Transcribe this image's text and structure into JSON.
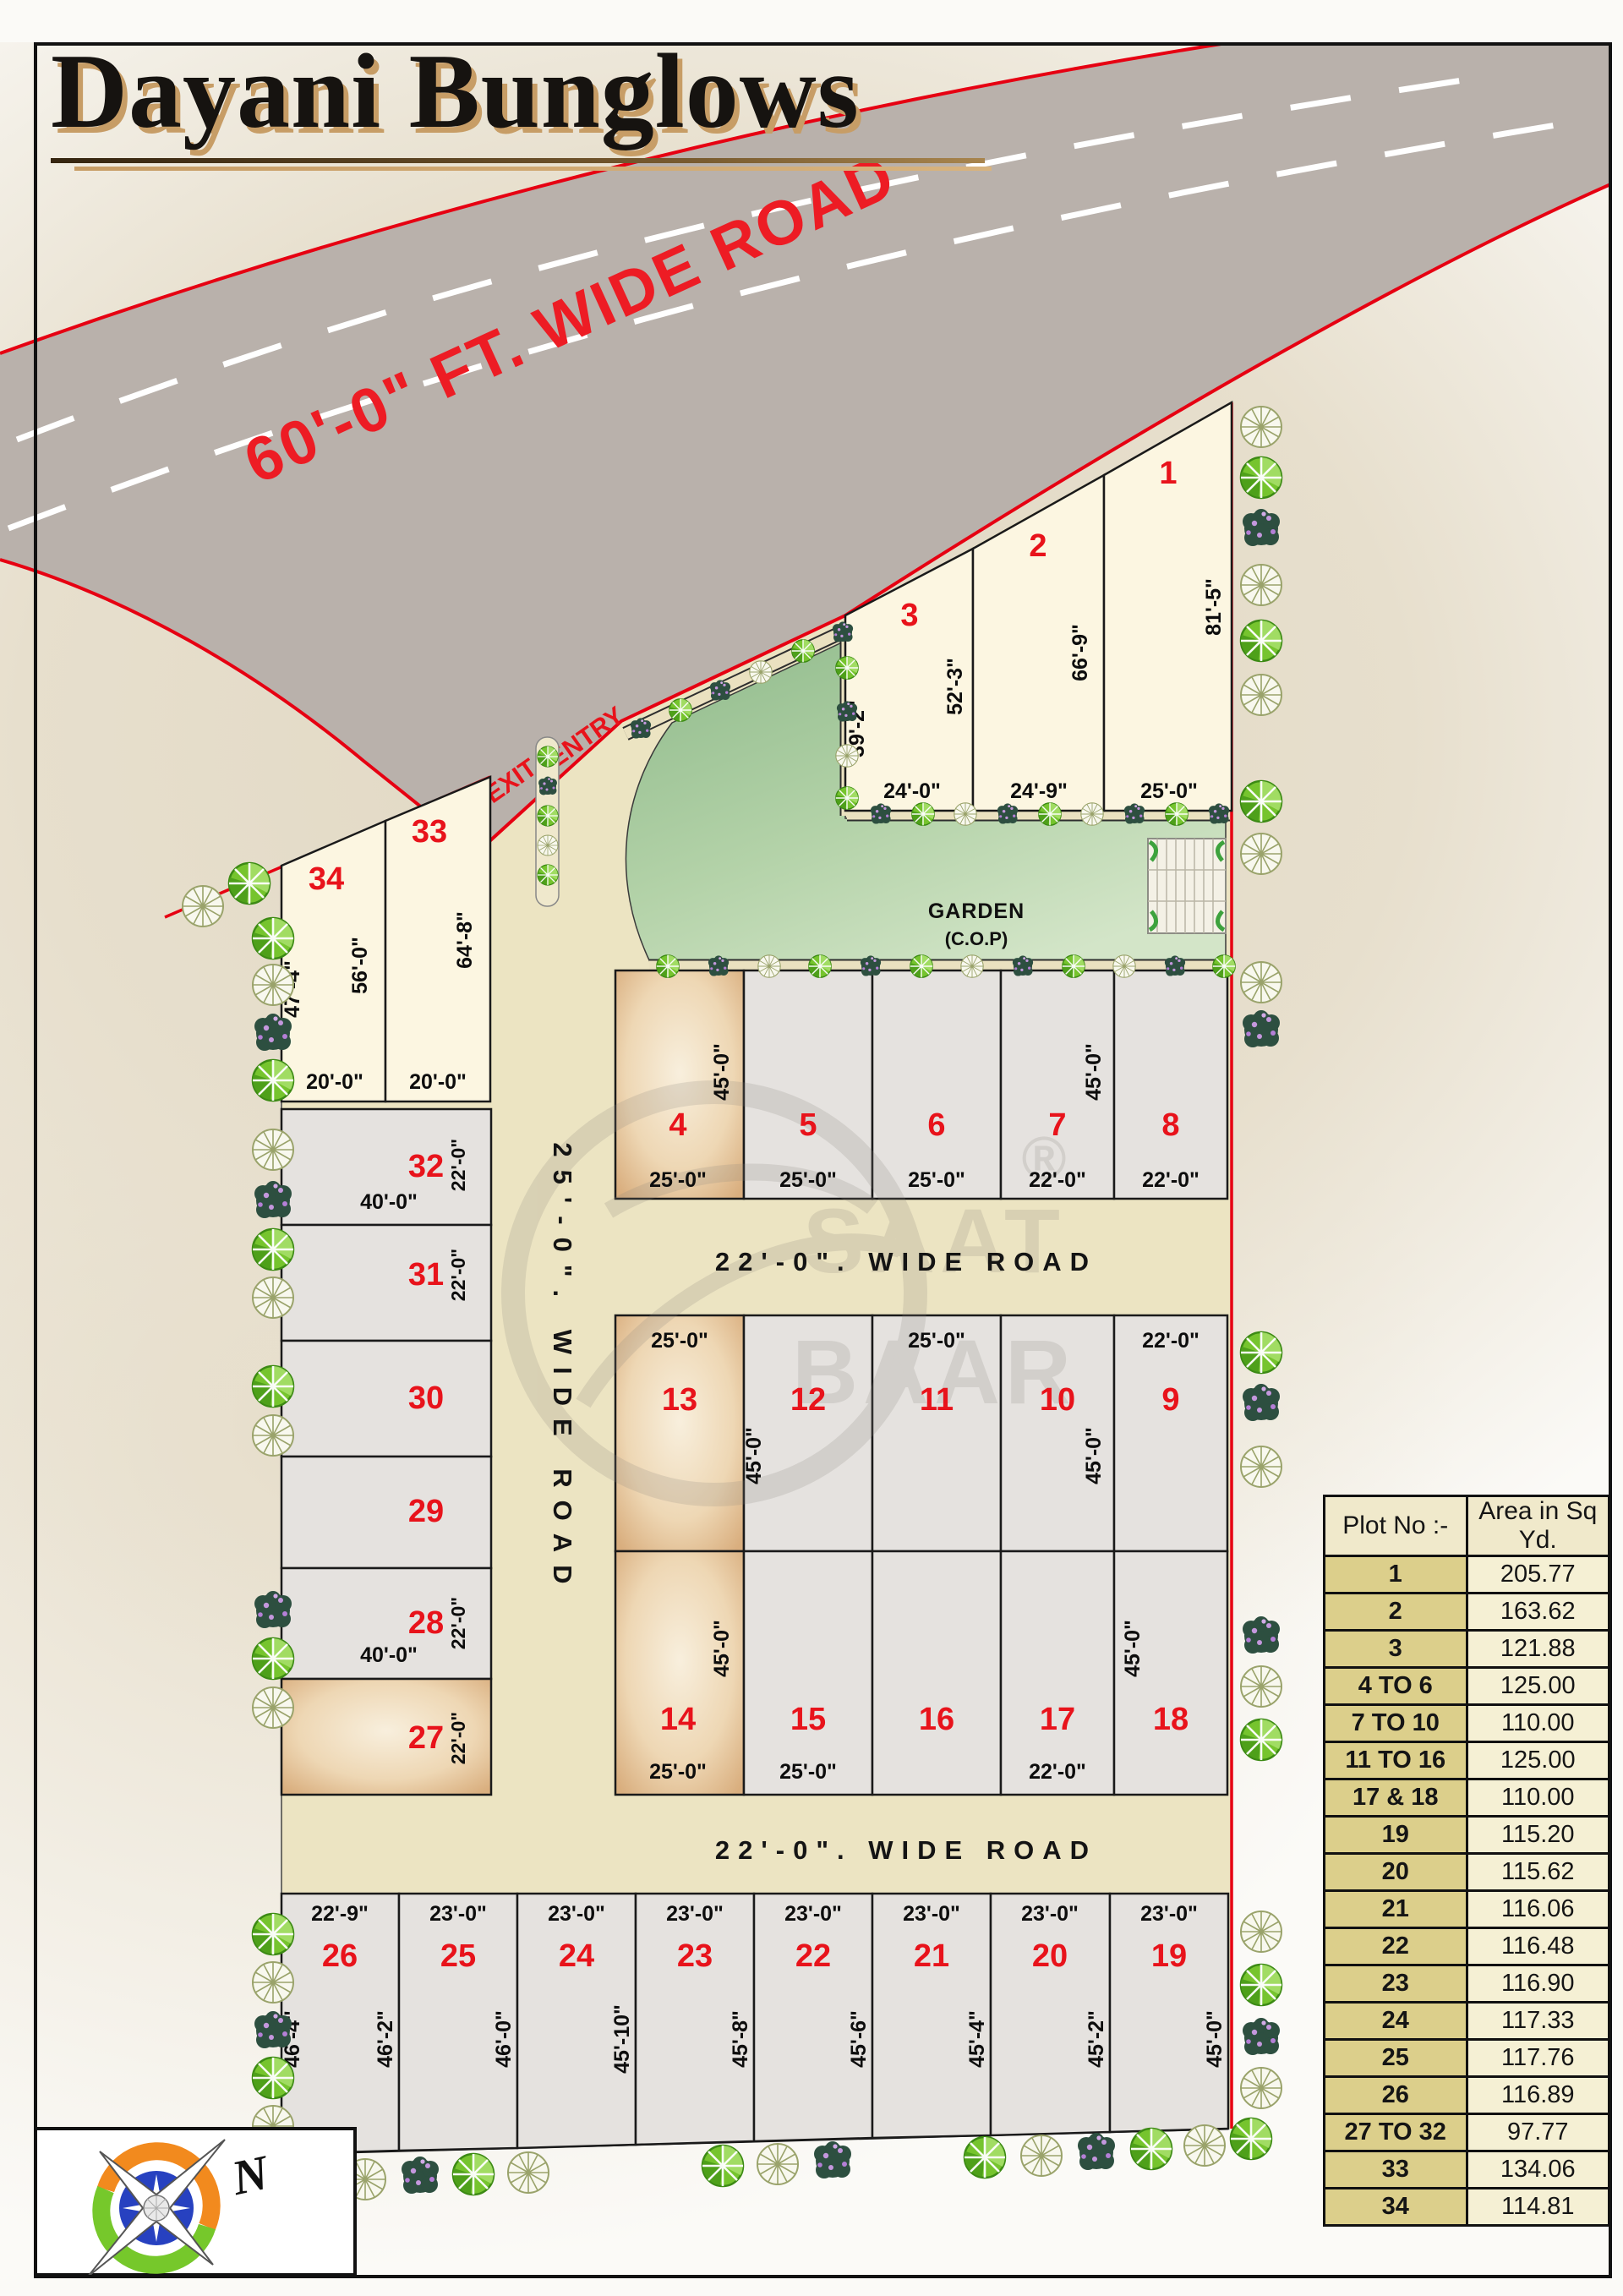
{
  "title": "Dayani Bunglows",
  "watermark": {
    "line1": "SAAT",
    "line2": "BAAR",
    "reg": "®"
  },
  "compass": {
    "north": "N"
  },
  "roads": {
    "main": "60'-0\"  FT. WIDE ROAD",
    "vertical": "25'-0\". WIDE ROAD",
    "cross1": "22'-0\". WIDE ROAD",
    "cross2": "22'-0\". WIDE ROAD",
    "entry": "ENTRY",
    "exit": "EXIT"
  },
  "garden": {
    "name": "GARDEN",
    "type": "(C.O.P)"
  },
  "colors": {
    "plot_number": "#e8131b",
    "road_line": "#e60012",
    "garden_green": "#9ec49a",
    "sold_tan": "#d9af80"
  },
  "plots": {
    "p1": {
      "no": "1",
      "side": "81'-5\"",
      "bottom": "25'-0\""
    },
    "p2": {
      "no": "2",
      "side": "66'-9\"",
      "bottom": "24'-9\""
    },
    "p3": {
      "no": "3",
      "left": "39'-2\"",
      "side": "52'-3\"",
      "bottom": "24'-0\""
    },
    "p4": {
      "no": "4",
      "side": "45'-0\"",
      "bottom": "25'-0\""
    },
    "p5": {
      "no": "5",
      "bottom": "25'-0\""
    },
    "p6": {
      "no": "6",
      "bottom": "25'-0\""
    },
    "p7": {
      "no": "7",
      "side": "45'-0\"",
      "bottom": "22'-0\""
    },
    "p8": {
      "no": "8",
      "bottom": "22'-0\""
    },
    "p9": {
      "no": "9",
      "top": "22'-0\""
    },
    "p10": {
      "no": "10",
      "side": "45'-0\""
    },
    "p11": {
      "no": "11",
      "top": "25'-0\""
    },
    "p12": {
      "no": "12",
      "side": "45'-0\""
    },
    "p13": {
      "no": "13",
      "top": "25'-0\""
    },
    "p14": {
      "no": "14",
      "side": "45'-0\"",
      "bottom": "25'-0\""
    },
    "p15": {
      "no": "15",
      "bottom": "25'-0\""
    },
    "p16": {
      "no": "16"
    },
    "p17": {
      "no": "17",
      "bottom": "22'-0\""
    },
    "p18": {
      "no": "18",
      "side": "45'-0\""
    },
    "p19": {
      "no": "19",
      "top": "23'-0\"",
      "side": "45'-0\""
    },
    "p20": {
      "no": "20",
      "top": "23'-0\"",
      "side": "45'-2\""
    },
    "p21": {
      "no": "21",
      "top": "23'-0\"",
      "side": "45'-4\""
    },
    "p22": {
      "no": "22",
      "top": "23'-0\"",
      "side": "45'-6\""
    },
    "p23": {
      "no": "23",
      "top": "23'-0\"",
      "side": "45'-8\""
    },
    "p24": {
      "no": "24",
      "top": "23'-0\"",
      "side": "45'-10\""
    },
    "p25": {
      "no": "25",
      "top": "23'-0\"",
      "side": "46'-0\""
    },
    "p26": {
      "no": "26",
      "top": "22'-9\"",
      "left": "46'-4\"",
      "side": "46'-2\""
    },
    "p27": {
      "no": "27",
      "side": "22'-0\""
    },
    "p28": {
      "no": "28",
      "side": "22'-0\"",
      "bottom": "40'-0\""
    },
    "p29": {
      "no": "29"
    },
    "p30": {
      "no": "30"
    },
    "p31": {
      "no": "31",
      "side": "22'-0\""
    },
    "p32": {
      "no": "32",
      "side": "22'-0\"",
      "bottom": "40'-0\""
    },
    "p33": {
      "no": "33",
      "side": "64'-8\"",
      "bottom": "20'-0\""
    },
    "p34": {
      "no": "34",
      "left": "47'-4\"",
      "side": "56'-0\"",
      "bottom": "20'-0\""
    }
  },
  "table": {
    "headers": [
      "Plot No :-",
      "Area in Sq Yd."
    ],
    "rows": [
      [
        "1",
        "205.77"
      ],
      [
        "2",
        "163.62"
      ],
      [
        "3",
        "121.88"
      ],
      [
        "4 TO 6",
        "125.00"
      ],
      [
        "7 TO 10",
        "110.00"
      ],
      [
        "11 TO 16",
        "125.00"
      ],
      [
        "17 & 18",
        "110.00"
      ],
      [
        "19",
        "115.20"
      ],
      [
        "20",
        "115.62"
      ],
      [
        "21",
        "116.06"
      ],
      [
        "22",
        "116.48"
      ],
      [
        "23",
        "116.90"
      ],
      [
        "24",
        "117.33"
      ],
      [
        "25",
        "117.76"
      ],
      [
        "26",
        "116.89"
      ],
      [
        "27 TO 32",
        "97.77"
      ],
      [
        "33",
        "134.06"
      ],
      [
        "34",
        "114.81"
      ]
    ]
  }
}
